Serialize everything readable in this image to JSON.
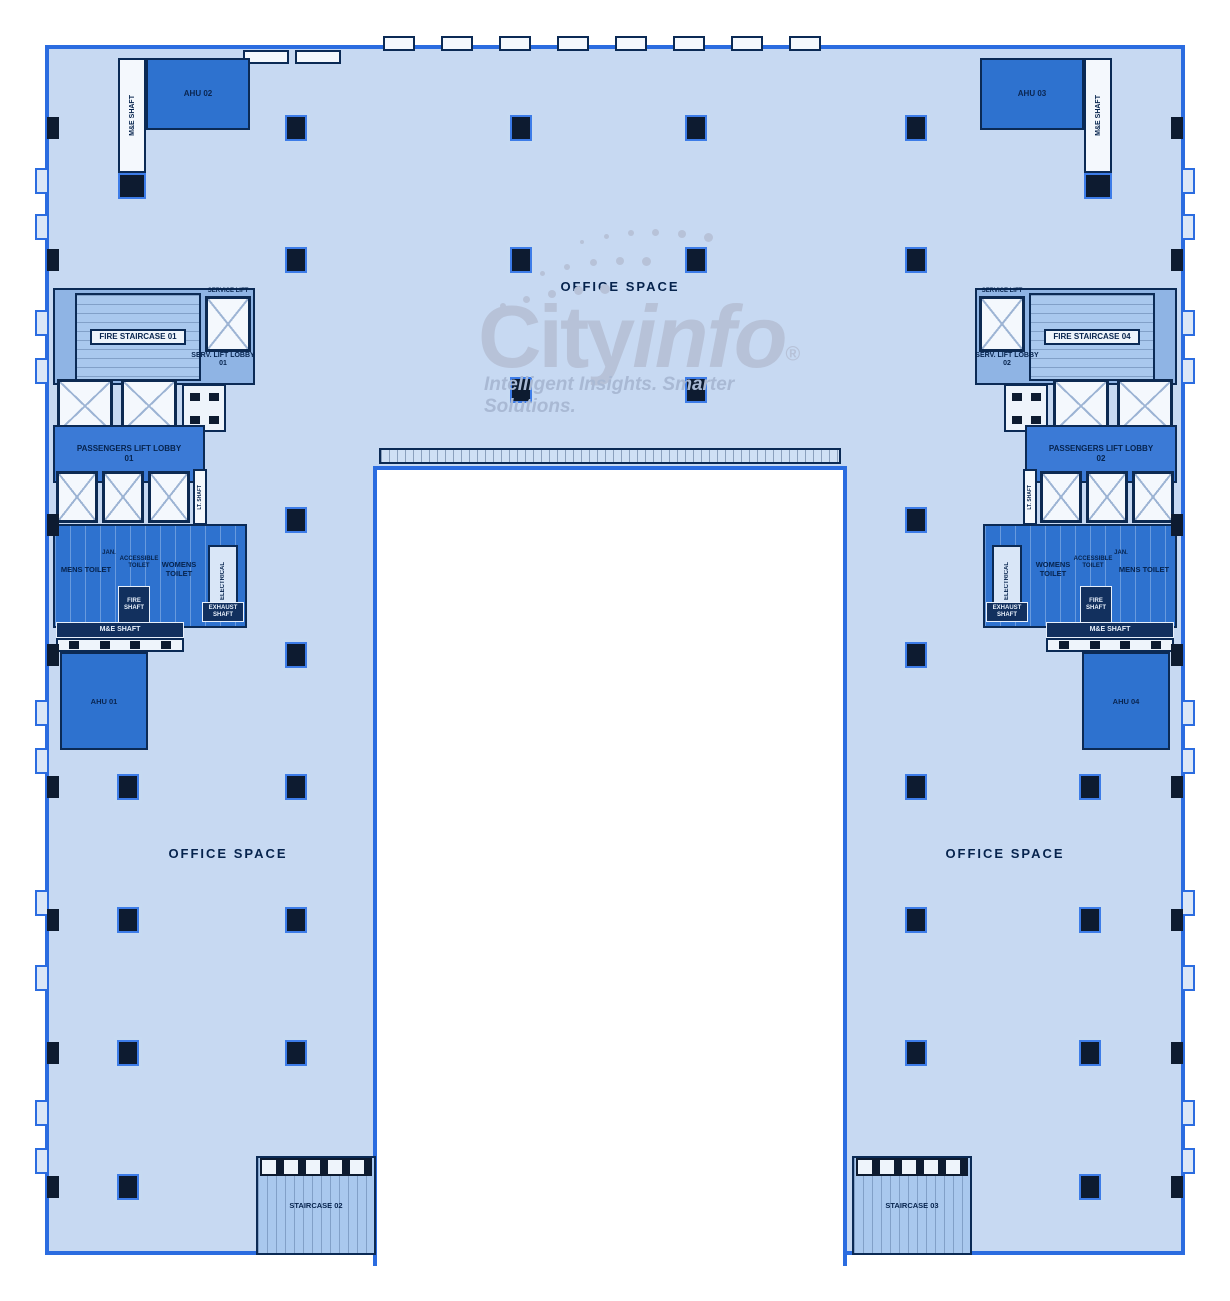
{
  "watermark": {
    "brand_city": "City",
    "brand_info": "info",
    "registered": "®",
    "tagline": "Intelligent Insights. Smarter Solutions."
  },
  "labels": {
    "office_space_top": "OFFICE SPACE",
    "office_space_left": "OFFICE SPACE",
    "office_space_right": "OFFICE SPACE"
  },
  "cores": {
    "left": {
      "fire_staircase": "FIRE STAIRCASE 01",
      "service_lift": "SERVICE LIFT",
      "serv_lift_lobby": "SERV. LIFT LOBBY 01",
      "passengers_lift_lobby": "PASSENGERS LIFT LOBBY 01",
      "mens_toilet": "MENS TOILET",
      "womens_toilet": "WOMENS TOILET",
      "accessible_toilet": "ACCESSIBLE TOILET",
      "janitor": "JAN.",
      "fire_shaft": "FIRE SHAFT",
      "electrical": "ELECTRICAL",
      "exhaust_shaft": "EXHAUST SHAFT",
      "me_shaft": "M&E SHAFT",
      "lt_shaft": "LT. SHAFT",
      "ahu_top": "AHU 02",
      "ahu_mid": "AHU 01",
      "staircase_bottom": "STAIRCASE 02",
      "me_shaft_top": "M&E SHAFT"
    },
    "right": {
      "fire_staircase": "FIRE STAIRCASE 04",
      "service_lift": "SERVICE LIFT",
      "serv_lift_lobby": "SERV. LIFT LOBBY 02",
      "passengers_lift_lobby": "PASSENGERS LIFT LOBBY 02",
      "mens_toilet": "MENS TOILET",
      "womens_toilet": "WOMENS TOILET",
      "accessible_toilet": "ACCESSIBLE TOILET",
      "janitor": "JAN.",
      "fire_shaft": "FIRE SHAFT",
      "electrical": "ELECTRICAL",
      "exhaust_shaft": "EXHAUST SHAFT",
      "me_shaft": "M&E SHAFT",
      "lt_shaft": "LT. SHAFT",
      "ahu_top": "AHU 03",
      "ahu_mid": "AHU 04",
      "staircase_bottom": "STAIRCASE 03",
      "me_shaft_top": "M&E SHAFT"
    }
  },
  "colors": {
    "building_fill": "#c7d9f2",
    "outline_blue": "#2b6ce0",
    "room_blue": "#2e72cf",
    "deep_navy": "#0d1b30",
    "text_navy": "#06234d",
    "watermark_gray": "#b7c2d8"
  },
  "structure": {
    "columns": [
      [
        296,
        128
      ],
      [
        521,
        128
      ],
      [
        696,
        128
      ],
      [
        916,
        128
      ],
      [
        296,
        260
      ],
      [
        521,
        260
      ],
      [
        696,
        260
      ],
      [
        916,
        260
      ],
      [
        521,
        390
      ],
      [
        696,
        390
      ],
      [
        296,
        520
      ],
      [
        916,
        520
      ],
      [
        296,
        655
      ],
      [
        916,
        655
      ],
      [
        128,
        787
      ],
      [
        296,
        787
      ],
      [
        916,
        787
      ],
      [
        1090,
        787
      ],
      [
        128,
        920
      ],
      [
        296,
        920
      ],
      [
        916,
        920
      ],
      [
        1090,
        920
      ],
      [
        128,
        1053
      ],
      [
        296,
        1053
      ],
      [
        916,
        1053
      ],
      [
        1090,
        1053
      ],
      [
        128,
        1187
      ],
      [
        1090,
        1187
      ]
    ],
    "wall_tick_ys": [
      128,
      260,
      525,
      655,
      787,
      920,
      1053,
      1187
    ],
    "facade_notch_ys": [
      168,
      214,
      310,
      358,
      700,
      748,
      890,
      965,
      1100,
      1148
    ],
    "crenel_xs": [
      383,
      441,
      499,
      557,
      615,
      673,
      731,
      789
    ],
    "wm_dots": [
      [
        500,
        303,
        6
      ],
      [
        523,
        296,
        7
      ],
      [
        548,
        290,
        8
      ],
      [
        574,
        286,
        9
      ],
      [
        600,
        284,
        10
      ],
      [
        540,
        271,
        5
      ],
      [
        564,
        264,
        6
      ],
      [
        590,
        259,
        7
      ],
      [
        616,
        257,
        8
      ],
      [
        642,
        257,
        9
      ],
      [
        580,
        240,
        4
      ],
      [
        604,
        234,
        5
      ],
      [
        628,
        230,
        6
      ],
      [
        652,
        229,
        7
      ],
      [
        678,
        230,
        8
      ],
      [
        704,
        233,
        9
      ]
    ]
  }
}
